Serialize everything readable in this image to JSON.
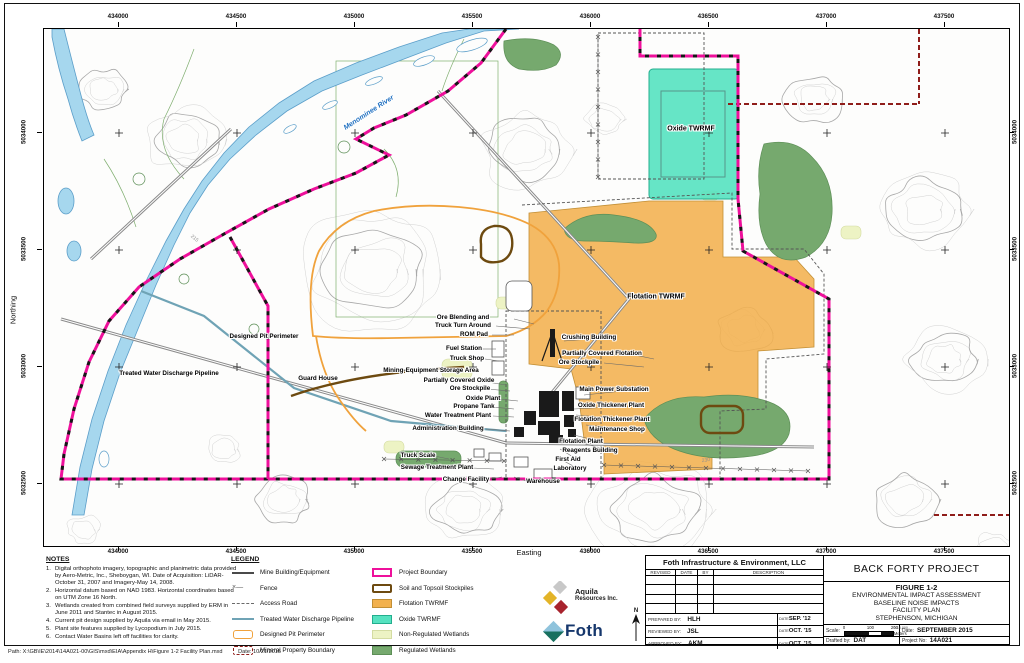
{
  "colors": {
    "project": "#ee109b",
    "mineral": "#8f1d1a",
    "pit": "#f0a23c",
    "soil": "#6d4a10",
    "pipeline": "#6fa3b5",
    "flot": "#f2b14e",
    "oxide": "#55e2c0",
    "oxideline": "#23ae8e",
    "nonreg": "#edf3c4",
    "reg": "#76a96e",
    "river": "#a6d7ee",
    "riverline": "#5b9ec9",
    "road": "#8a8a8a",
    "contour": "#d2d2d2",
    "contourmajor": "#a8a8a8"
  },
  "axes": {
    "easting_label": "Easting",
    "northing_label": "Northing",
    "easting_ticks": [
      "434000",
      "434500",
      "435000",
      "435500",
      "436000",
      "436500",
      "437000",
      "437500"
    ],
    "northing_ticks": [
      "5034000",
      "5033500",
      "5033000",
      "5032500"
    ]
  },
  "map_labels": [
    {
      "t": "Menominee River",
      "x": 325,
      "y": 84,
      "r": -33,
      "c": "river",
      "s": 7
    },
    {
      "t": "Oxide TWRMF",
      "x": 647,
      "y": 100,
      "s": 7
    },
    {
      "t": "Flotation TWRMF",
      "x": 612,
      "y": 268,
      "s": 7
    },
    {
      "t": "Designed Pit Perimeter",
      "x": 220,
      "y": 308
    },
    {
      "t": "Treated Water Discharge Pipeline",
      "x": 125,
      "y": 345
    },
    {
      "t": "Guard House",
      "x": 274,
      "y": 350
    },
    {
      "t": "Ore Blending and",
      "x": 419,
      "y": 289
    },
    {
      "t": "Truck Turn Around",
      "x": 419,
      "y": 297
    },
    {
      "t": "ROM Pad",
      "x": 430,
      "y": 306
    },
    {
      "t": "Fuel Station",
      "x": 420,
      "y": 320
    },
    {
      "t": "Truck Shop",
      "x": 423,
      "y": 330
    },
    {
      "t": "Mining-Equipment Storage Area",
      "x": 387,
      "y": 342
    },
    {
      "t": "Partially Covered Oxide",
      "x": 415,
      "y": 352
    },
    {
      "t": "Ore Stockpile",
      "x": 426,
      "y": 360
    },
    {
      "t": "Oxide Plant",
      "x": 439,
      "y": 370
    },
    {
      "t": "Propane Tank",
      "x": 430,
      "y": 378
    },
    {
      "t": "Water Treatment Plant",
      "x": 414,
      "y": 387
    },
    {
      "t": "Administration Building",
      "x": 404,
      "y": 400
    },
    {
      "t": "Truck Scale",
      "x": 374,
      "y": 427
    },
    {
      "t": "Sewage Treatment Plant",
      "x": 393,
      "y": 439
    },
    {
      "t": "Change Facility",
      "x": 422,
      "y": 451
    },
    {
      "t": "Warehouse",
      "x": 499,
      "y": 453
    },
    {
      "t": "Crushing Building",
      "x": 545,
      "y": 309
    },
    {
      "t": "Partially Covered Flotation",
      "x": 558,
      "y": 325
    },
    {
      "t": "Ore Stockpile",
      "x": 535,
      "y": 334
    },
    {
      "t": "Main Power Substation",
      "x": 570,
      "y": 361
    },
    {
      "t": "Oxide Thickener Plant",
      "x": 567,
      "y": 377
    },
    {
      "t": "Flotation Thickener Plant",
      "x": 568,
      "y": 391
    },
    {
      "t": "Maintenance Shop",
      "x": 573,
      "y": 401
    },
    {
      "t": "Flotation Plant",
      "x": 537,
      "y": 413
    },
    {
      "t": "Reagents Building",
      "x": 546,
      "y": 422
    },
    {
      "t": "First Aid",
      "x": 524,
      "y": 431
    },
    {
      "t": "Laboratory",
      "x": 526,
      "y": 440
    },
    {
      "t": "215",
      "x": 150,
      "y": 210,
      "r": 40,
      "c": "contour"
    },
    {
      "t": "230",
      "x": 662,
      "y": 432,
      "r": -8,
      "c": "contour"
    }
  ],
  "notes": {
    "title": "NOTES",
    "items": [
      "Digital orthophoto imagery, topographic and planimetric data provided by Aero-Metric, Inc., Sheboygan, WI. Date of Acquisition: LiDAR-October 31, 2007 and Imagery-May 14, 2008.",
      "Horizontal datum based on NAD 1983. Horizontal coordinates based on UTM Zone 16 North.",
      "Wetlands created from combined field surveys supplied by ERM in June 2011 and Stantec in August 2015.",
      "Current pit design supplied by Aquila via email in May 2015.",
      "Plant site features supplied by Lycopodium in July 2015.",
      "Contact Water Basins left off facilities for clarity."
    ]
  },
  "legend": {
    "title": "LEGEND",
    "col1": [
      {
        "label": "Mine Building/Equipment",
        "swatch": "mine"
      },
      {
        "label": "Fence",
        "swatch": "fence"
      },
      {
        "label": "Access Road",
        "swatch": "access"
      },
      {
        "label": "Treated Water Discharge Pipeline",
        "swatch": "pipe"
      },
      {
        "label": "Designed Pit Perimeter",
        "swatch": "pit"
      },
      {
        "label": "Mineral Property Boundary",
        "swatch": "mineral"
      }
    ],
    "col2": [
      {
        "label": "Project Boundary",
        "swatch": "project"
      },
      {
        "label": "Soil and Topsoil Stockpiles",
        "swatch": "soil"
      },
      {
        "label": "Flotation TWRMF",
        "swatch": "flot"
      },
      {
        "label": "Oxide TWRMF",
        "swatch": "oxide"
      },
      {
        "label": "Non-Regulated Wetlands",
        "swatch": "nonreg"
      },
      {
        "label": "Regulated Wetlands",
        "swatch": "reg"
      }
    ]
  },
  "logos": {
    "aquila_name": "Aquila",
    "aquila_sub": "Resources Inc.",
    "foth_name": "Foth",
    "north_label": "N"
  },
  "title_block": {
    "company": "Foth Infrastructure & Environment, LLC",
    "rev_headers": [
      "REVISED",
      "DATE",
      "BY",
      "DESCRIPTION"
    ],
    "sign_rows": [
      {
        "label": "PREPARED BY:",
        "value": "HLH",
        "date_label": "DATE",
        "date": "SEP. '12"
      },
      {
        "label": "REVIEWED BY:",
        "value": "JSL",
        "date_label": "DATE",
        "date": "OCT. '15"
      },
      {
        "label": "APPROVED BY:",
        "value": "AKM",
        "date_label": "DATE",
        "date": "OCT. '15"
      }
    ],
    "project": "BACK FORTY PROJECT",
    "figure_no": "FIGURE 1-2",
    "figure_lines": [
      "ENVIRONMENTAL IMPACT ASSESSMENT",
      "BASELINE NOISE IMPACTS",
      "FACILITY PLAN",
      "STEPHENSON, MICHIGAN"
    ],
    "scale_label": "Scale:",
    "scale_ticks": [
      "0",
      "100",
      "200"
    ],
    "scale_ratio": "1:10,000",
    "scale_unit": "Meters",
    "date_label": "Date:",
    "date": "SEPTEMBER 2015",
    "drafted_label": "Drafted by:",
    "drafted": "DAT",
    "project_no_label": "Project No:",
    "project_no": "14A021"
  },
  "figure": {
    "path_line": "Path: X:\\GB\\IE\\2014\\14A021-00\\GIS\\mxd\\EIA\\Appendix H\\Figure 1-2 Facility Plan.mxd",
    "path_date": "Date: 10/21/2015"
  }
}
